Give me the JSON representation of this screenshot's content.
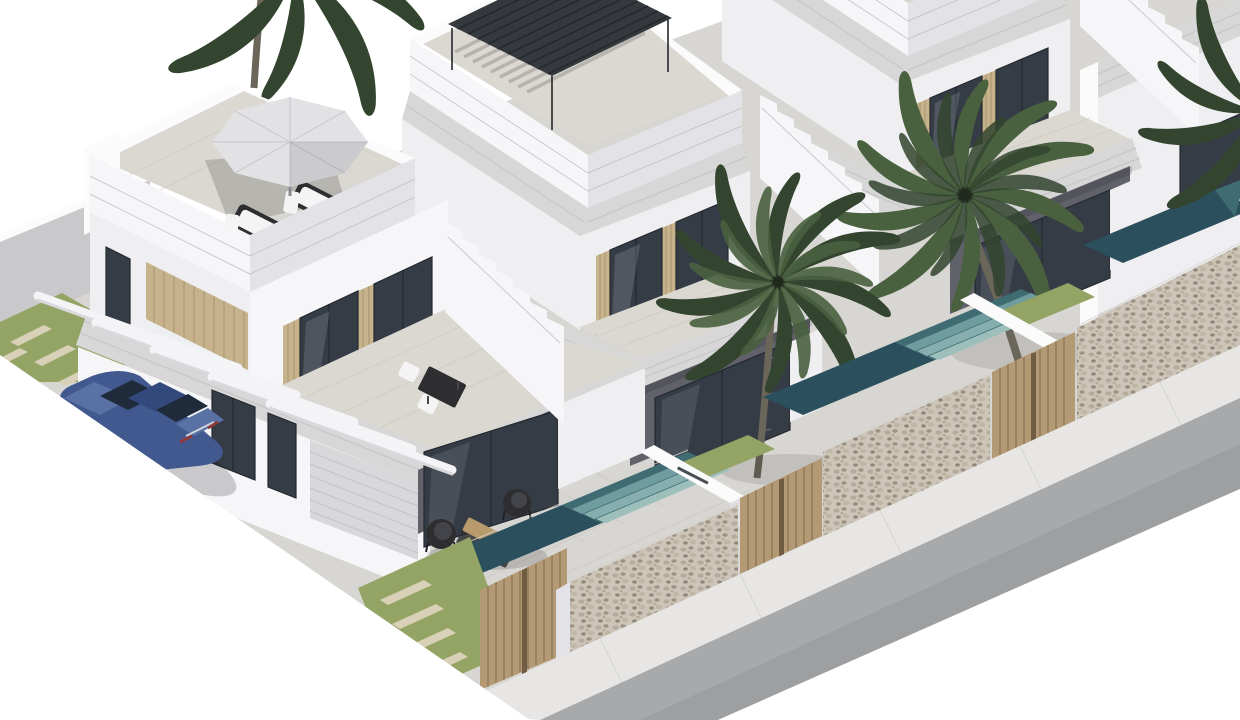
{
  "meta": {
    "title": "Architectural 3D rendering: row of modern two-storey white villas with rooftop terraces, private pools, palm trees, stone street wall with wooden gates, and a blue sedan parked under white carport beams",
    "view": "aerial axonometric",
    "style": "photorealistic exterior render on white background"
  },
  "palette": {
    "sky": "#ffffff",
    "ground": "#d8d6d2",
    "road": "#a8a9ab",
    "sidewalk": "#e7e6e4",
    "sidewalk_line": "#d3d2d0",
    "wall_white": "#f6f6f8",
    "wall_bright": "#fbfbfc",
    "wall_light": "#efeff2",
    "wall_shade": "#e3e3e7",
    "back_wall": "#c9c9cb",
    "fascia": "#d7d7d8",
    "fascia_line": "#bfbfc2",
    "recess_shadow": "#61616a",
    "glass": "#353c46",
    "glass_light": "#8b96a4",
    "glass_frame": "#23282f",
    "slat_wood": "#c6b28b",
    "slat_wood_dark": "#a28c64",
    "gate_wood": "#b39a75",
    "gate_wood_light": "#c9b38e",
    "gate_frame": "#6f5c42",
    "stone_base": "#cdc5b7",
    "stone_s1": "#b5ab9c",
    "stone_s2": "#9c9284",
    "stone_s3": "#c0b6a5",
    "stone_s4": "#8f8678",
    "grass": "#94a464",
    "paver": "#d9d0b8",
    "pool_deep": "#2b4f5c",
    "pool_mid": "#3f6b72",
    "pool_step1": "#6f9c9e",
    "pool_step2": "#86aeae",
    "pool_step3": "#9cbfbc",
    "pergola": "#35393d",
    "pergola_dark": "#24272b",
    "umbrella": "#e2e2e5",
    "umbrella_seam": "#c7c7cb",
    "terrace_tile": "#dbd8d2",
    "tile_line": "#c6c3bd",
    "palm_a": "#33452f",
    "palm_b": "#49613f",
    "palm_trunk": "#6b665a",
    "car_body": "#41598f",
    "car_body_light": "#5a71a5",
    "car_roof": "#33497c",
    "car_glass": "#1f2a3a",
    "car_wheel": "#26262a",
    "furniture_dark": "#2e2e31",
    "cushion": "#f4f4f4",
    "table_wood": "#b99a6d",
    "garage_door": "#d8d8da",
    "garage_line": "#bdbdc1"
  },
  "scene": {
    "villas": [
      {
        "id": "villa-1",
        "position": "front-left",
        "features": [
          "rooftop terrace with grey parasol and two sun loungers",
          "first-floor balcony with dining set",
          "wood-slat facade panel",
          "garage door",
          "carport with five white beams",
          "ground-floor glass sliding doors",
          "patio with wicker chairs and coffee table"
        ]
      },
      {
        "id": "villa-2",
        "position": "second",
        "features": [
          "black louvered rooftop pergola",
          "terrace with glass sliding doors",
          "stepped stair parapet",
          "private pool"
        ]
      },
      {
        "id": "villa-3",
        "position": "third",
        "features": [
          "terrace with glass sliding doors",
          "stepped stair parapet",
          "private pool",
          "palm tree in front garden"
        ]
      },
      {
        "id": "villa-4",
        "position": "far-right (partially visible)",
        "features": [
          "white side wall",
          "glass door"
        ]
      }
    ],
    "vehicle": {
      "id": "blue-sedan",
      "color_name": "steel blue",
      "location": "driveway beside villa 1"
    },
    "vegetation": [
      "palm tree between villa 1 and villa 2",
      "palm tree in front of villa 3",
      "palm fronds top-left",
      "palm fronds right edge",
      "grass strips with stepping pavers"
    ],
    "street": [
      "stone masonry boundary wall segments",
      "vertical wood-slat gates",
      "light sidewalk",
      "grey asphalt road running diagonally bottom-right"
    ],
    "pools": [
      "villa 1 pool with teal steps",
      "villa 2 pool with teal steps",
      "villa 3 pool (partially hidden)"
    ]
  }
}
